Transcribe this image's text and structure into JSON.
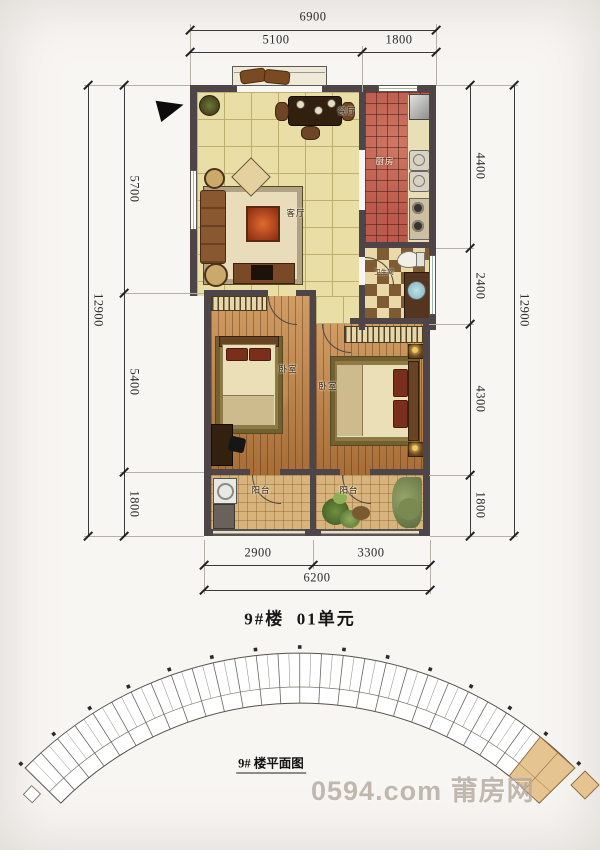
{
  "captions": {
    "unit_title": "9#楼  01单元",
    "building_plan_label": "9# 楼平面图",
    "watermark": "0594.com 莆房网"
  },
  "rooms": {
    "living": "客厅",
    "dining": "餐厅",
    "kitchen": "厨房",
    "bathroom": "卫生间",
    "bedroom_left": "卧室",
    "bedroom_right": "卧室",
    "balcony_left": "阳台",
    "balcony_right": "阳台"
  },
  "dimensions": {
    "top": {
      "total": "6900",
      "segments": [
        "5100",
        "1800"
      ]
    },
    "left": {
      "total": "12900",
      "segments": [
        "5700",
        "5400",
        "1800"
      ]
    },
    "right": {
      "total": "12900",
      "segments": [
        "4400",
        "2400",
        "4300",
        "1800"
      ]
    },
    "bottom": {
      "total": "6200",
      "segments": [
        "2900",
        "3300"
      ]
    }
  },
  "colors": {
    "wall": "#4d4547",
    "tile": "#e9dfa6",
    "tile-line": "#bdae72",
    "kitchen": "#bb5a4c",
    "checker-dark": "#7f5b33",
    "checker-light": "#ead9a8",
    "wood": "#c28347",
    "balcony": "#d8b47c",
    "rug": "#8f7b41",
    "bed": "#ebdfb8",
    "highlight-unit": "#e6c490",
    "dim": "#2b2b2b",
    "watermark": "#b3a89d"
  }
}
